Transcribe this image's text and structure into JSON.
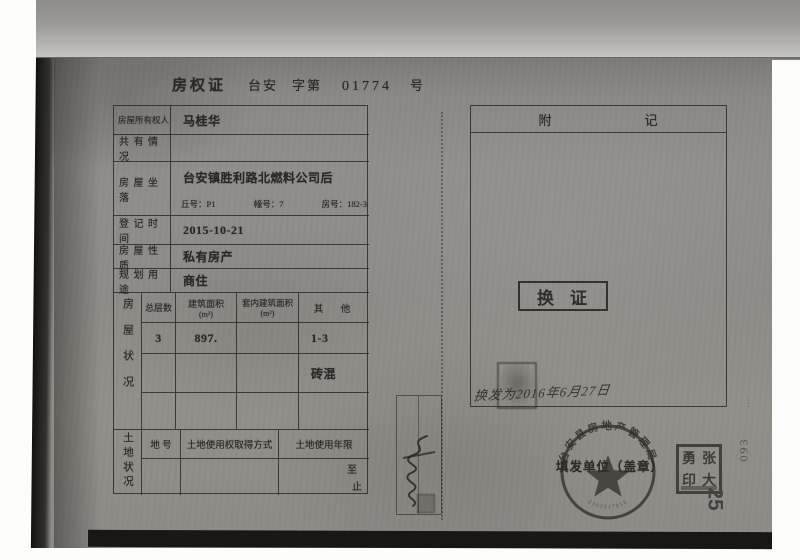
{
  "scan": {
    "title": {
      "doc_type": "房权证",
      "region": "台安",
      "zidi": "字第",
      "serial": "01774",
      "hao": "号"
    },
    "table": {
      "owner": {
        "label": "房屋所有权人",
        "value": "马桂华"
      },
      "co_ownership": {
        "label": "共 有 情 况",
        "value": ""
      },
      "location": {
        "label": "房 屋 坐 落",
        "value": "台安镇胜利路北燃料公司后",
        "plot": "丘号：P1",
        "building": "幢号：7",
        "room": "房号：182-3"
      },
      "reg_date": {
        "label": "登 记 时 间",
        "value": "2015-10-21"
      },
      "nature": {
        "label": "房 屋 性 质",
        "value": "私有房产"
      },
      "usage": {
        "label": "规 划 用 途",
        "value": "商住"
      },
      "house": {
        "side_label": "房屋状况",
        "headers": [
          {
            "t": "总层数",
            "u": ""
          },
          {
            "t": "建筑面积",
            "u": "(m²)"
          },
          {
            "t": "套内建筑面积",
            "u": "(m²)"
          },
          {
            "t": "其　他",
            "u": ""
          }
        ],
        "rows": [
          [
            "3",
            "897.",
            "",
            "1-3"
          ],
          [
            "",
            "",
            "",
            "砖混"
          ],
          [
            "",
            "",
            "",
            ""
          ]
        ]
      },
      "land": {
        "side_label": "土地状况",
        "headers": [
          "地 号",
          "土地使用权取得方式",
          "土地使用年限"
        ],
        "term_to": "至",
        "term_end": "止"
      }
    },
    "remarks": {
      "header_left": "附",
      "header_right": "记",
      "exchange_stamp": "换证",
      "handwriting": "换发为2016年6月27日"
    },
    "seals": {
      "issuer_label": "填发单位（盖章）",
      "round_seal_text": "台安县房地产管理局",
      "round_seal_numbers": "2103217018",
      "name_seal": {
        "tl": "勇",
        "tr": "张",
        "bl": "印",
        "br": "大"
      }
    },
    "margins": {
      "page_number": "25",
      "file_number": "093"
    }
  }
}
